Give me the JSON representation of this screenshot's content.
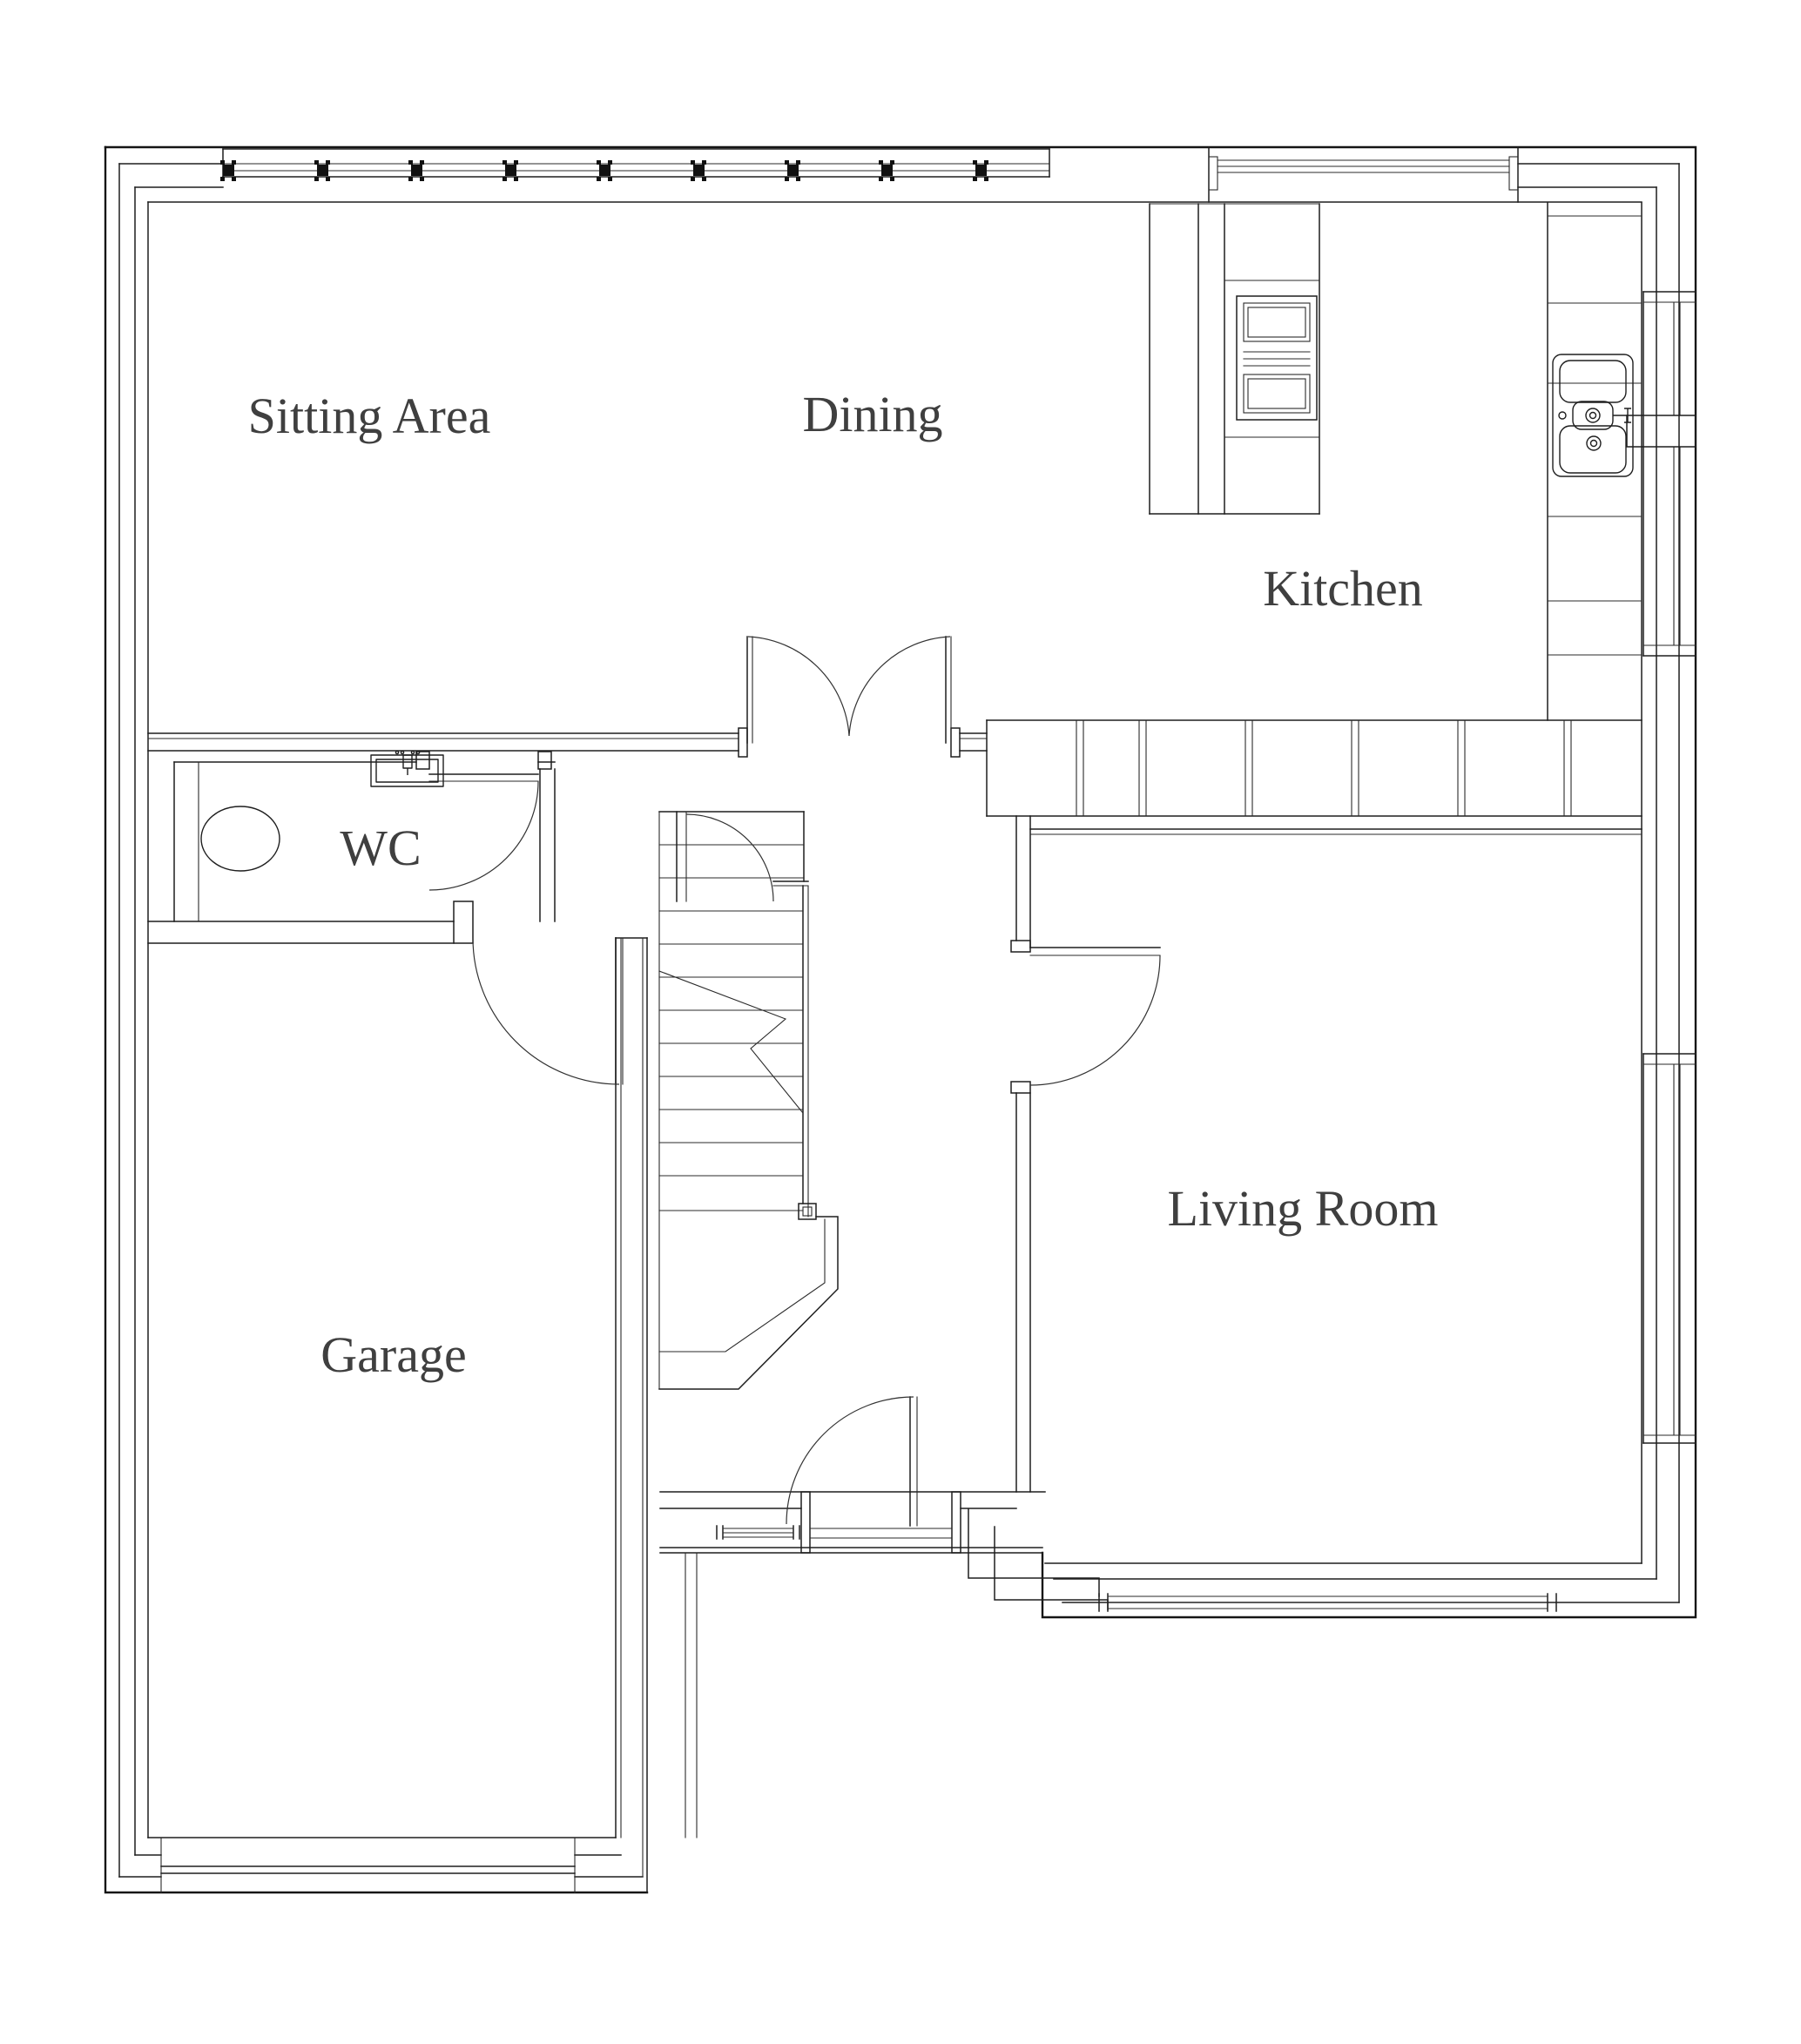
{
  "rooms": [
    {
      "id": "sitting-area",
      "label": "Sitting Area"
    },
    {
      "id": "dining",
      "label": "Dining"
    },
    {
      "id": "kitchen",
      "label": "Kitchen"
    },
    {
      "id": "wc",
      "label": "WC"
    },
    {
      "id": "garage",
      "label": "Garage"
    },
    {
      "id": "living-room",
      "label": "Living Room"
    }
  ],
  "symbols": {
    "toilet": "toilet-symbol",
    "wc_basin": "wc-basin-symbol",
    "kitchen_sink": "kitchen-sink-symbol",
    "oven_stack": "oven-symbol",
    "stairs": "stairs-symbol",
    "garage_door": "garage-door-symbol",
    "front_door": "front-door-symbol"
  },
  "colors": {
    "background": "#ffffff",
    "wall_line": "#1e1e1e",
    "label_text": "#3f3f3f"
  }
}
